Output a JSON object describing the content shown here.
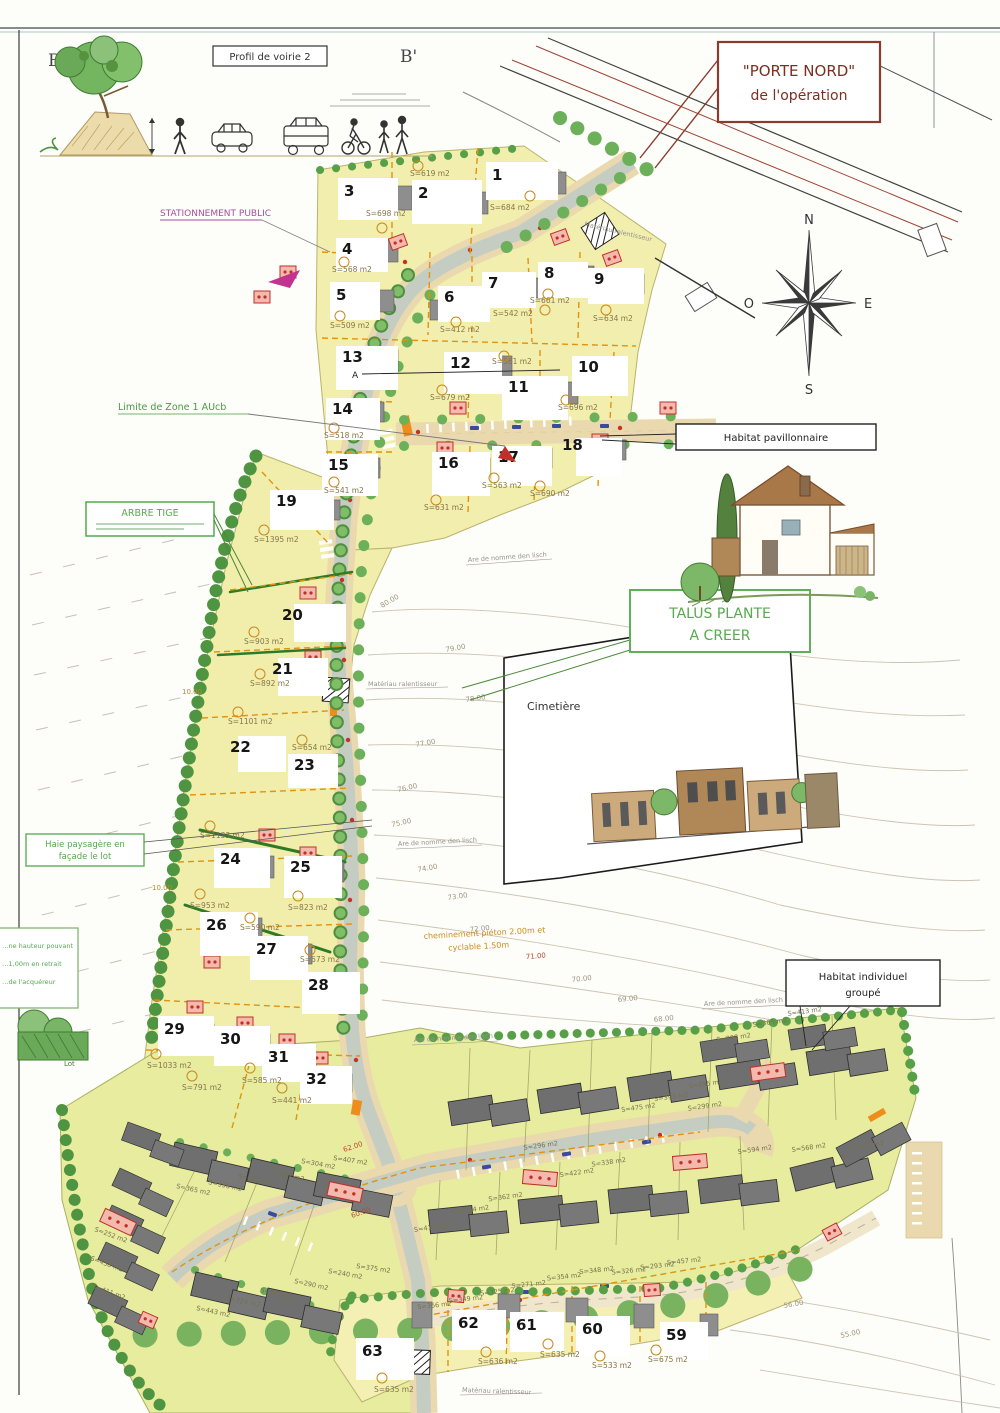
{
  "profile": {
    "b": "B",
    "b_prime": "B'",
    "box": "Profil de voirie 2"
  },
  "compass": {
    "n": "N",
    "e": "E",
    "s": "S",
    "o": "O"
  },
  "callouts": {
    "porte_nord1": "\"PORTE NORD\"",
    "porte_nord2": "de l'opération",
    "stationnement": "STATIONNEMENT PUBLIC",
    "limite_zone": "Limite de Zone 1 AUcb",
    "arbre_tige": "ARBRE TIGE",
    "talus1": "TALUS PLANTE",
    "talus2": "A CREER",
    "haie1": "Haie paysagère en",
    "haie2": "façade le lot",
    "haie_g1": "…ne hauteur pouvant",
    "haie_g2": "…1,00m en retrait",
    "haie_g3": "…de l'acquéreur",
    "lot_label": "Lot",
    "habitat_pav": "Habitat pavillonnaire",
    "habitat_grp1": "Habitat individuel",
    "habitat_grp2": "groupé",
    "cimetiere": "Cimetière",
    "chem1": "cheminement piéton 2.00m et",
    "chem2": "cyclable 1.50m",
    "ralentisseur": "Matériau ralentisseur",
    "place_name": "Are de nomme den lisch",
    "section_a": "A"
  },
  "lots": [
    {
      "n": "1",
      "a": "S=684 m2"
    },
    {
      "n": "2",
      "a": "S=619 m2"
    },
    {
      "n": "3",
      "a": "S=698 m2"
    },
    {
      "n": "4",
      "a": "S=568 m2"
    },
    {
      "n": "5",
      "a": "S=509 m2"
    },
    {
      "n": "6",
      "a": "S=412 m2"
    },
    {
      "n": "7",
      "a": "S=542 m2"
    },
    {
      "n": "8",
      "a": "S=661 m2"
    },
    {
      "n": "9",
      "a": "S=634 m2"
    },
    {
      "n": "10",
      "a": "S=696 m2"
    },
    {
      "n": "11",
      "a": "S=561 m2"
    },
    {
      "n": "12",
      "a": "S=679 m2"
    },
    {
      "n": "13",
      "a": ""
    },
    {
      "n": "14",
      "a": "S=518 m2"
    },
    {
      "n": "15",
      "a": "S=541 m2"
    },
    {
      "n": "16",
      "a": "S=631 m2"
    },
    {
      "n": "17",
      "a": "S=563 m2"
    },
    {
      "n": "18",
      "a": "S=690 m2"
    },
    {
      "n": "19",
      "a": "S=1395 m2"
    },
    {
      "n": "20",
      "a": "S=903 m2"
    },
    {
      "n": "21",
      "a": "S=892 m2"
    },
    {
      "n": "22",
      "a": "S=1101 m2"
    },
    {
      "n": "23",
      "a": "S=654 m2"
    },
    {
      "n": "24",
      "a": "S=1133 m2"
    },
    {
      "n": "25",
      "a": "S=823 m2"
    },
    {
      "n": "26",
      "a": "S=953 m2"
    },
    {
      "n": "27",
      "a": "S=590 m2"
    },
    {
      "n": "28",
      "a": "S=673 m2"
    },
    {
      "n": "29",
      "a": "S=1033 m2"
    },
    {
      "n": "30",
      "a": "S=791 m2"
    },
    {
      "n": "31",
      "a": "S=585 m2"
    },
    {
      "n": "32",
      "a": "S=441 m2"
    }
  ],
  "lots_bottom": [
    {
      "n": "63",
      "a": "S=635 m2"
    },
    {
      "n": "62",
      "a": "S=636 m2"
    },
    {
      "n": "61",
      "a": "S=635 m2"
    },
    {
      "n": "60",
      "a": "S=533 m2"
    },
    {
      "n": "59",
      "a": "S=675 m2"
    }
  ],
  "group_areas": {
    "right_top": [
      "S=415 m2",
      "S=264 m2",
      "S=362 m2",
      "S=296 m2",
      "S=422 m2",
      "S=338 m2",
      "S=475 m2",
      "S=393 m2",
      "S=295 m2",
      "S=299 m2",
      "S=298 m2",
      "S=365 m2",
      "S=413 m2"
    ],
    "right_bottom": [
      "S=366 m2",
      "S=349 m2",
      "S=325 m2",
      "S=271 m2",
      "S=354 m2",
      "S=348 m2",
      "S=326 m2",
      "S=293 m2",
      "S=457 m2"
    ],
    "left": [
      "S=365 m2",
      "S=336 m2",
      "S=421 m2",
      "S=407 m2",
      "S=304 m2",
      "S=407 m2",
      "S=252 m2",
      "S=438 m2",
      "S=411 m2",
      "S=443 m2",
      "S=224 m2",
      "S=329 m2",
      "S=290 m2",
      "S=240 m2",
      "S=375 m2"
    ],
    "right_side": [
      "S=594 m2",
      "S=568 m2",
      "S=470 m2"
    ]
  },
  "levels": {
    "contours": [
      "80.00",
      "79.00",
      "78.00",
      "77.00",
      "76.00",
      "75.00",
      "74.00",
      "73.00",
      "72.00",
      "71.00",
      "70.00",
      "69.00",
      "68.00",
      "56.00",
      "55.00"
    ],
    "street": [
      "62.00",
      "60.00"
    ],
    "dims": [
      "10.00",
      "10.00"
    ]
  }
}
